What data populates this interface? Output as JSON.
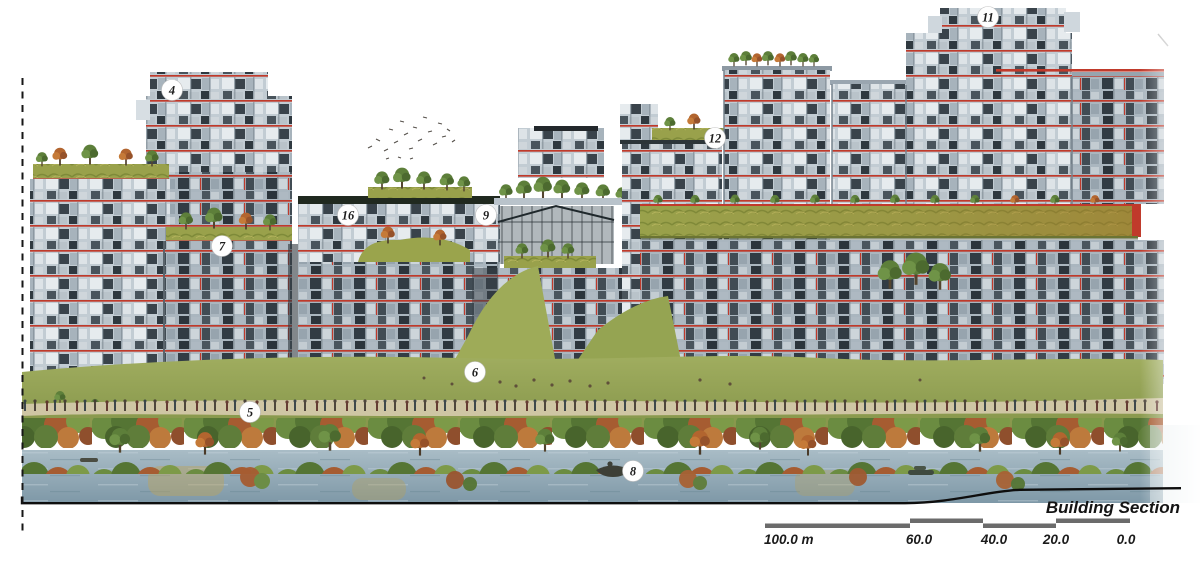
{
  "title": "Building Section",
  "annotation": {
    "label": "Building Section"
  },
  "scalebar": {
    "labels": [
      "100.0 m",
      "60.0",
      "40.0",
      "20.0",
      "0.0"
    ]
  },
  "markers": [
    {
      "id": "4",
      "label": "4"
    },
    {
      "id": "7",
      "label": "7"
    },
    {
      "id": "16",
      "label": "16"
    },
    {
      "id": "9",
      "label": "9"
    },
    {
      "id": "12",
      "label": "12"
    },
    {
      "id": "11",
      "label": "11"
    },
    {
      "id": "6",
      "label": "6"
    },
    {
      "id": "5",
      "label": "5"
    },
    {
      "id": "8",
      "label": "8"
    }
  ],
  "colors": {
    "accent_red": "#c03a2b",
    "facade_light": "#c6cfd6",
    "interior_dark": "#39434b",
    "roof_grass": "#99a14b",
    "meadow_green": "#95a254",
    "shrub_green": "#6b8c41",
    "shrub_rust": "#a65c31",
    "water_blue": "#8fa8b5",
    "ink": "#151515",
    "scalebar_gray": "#6b6b6b"
  }
}
